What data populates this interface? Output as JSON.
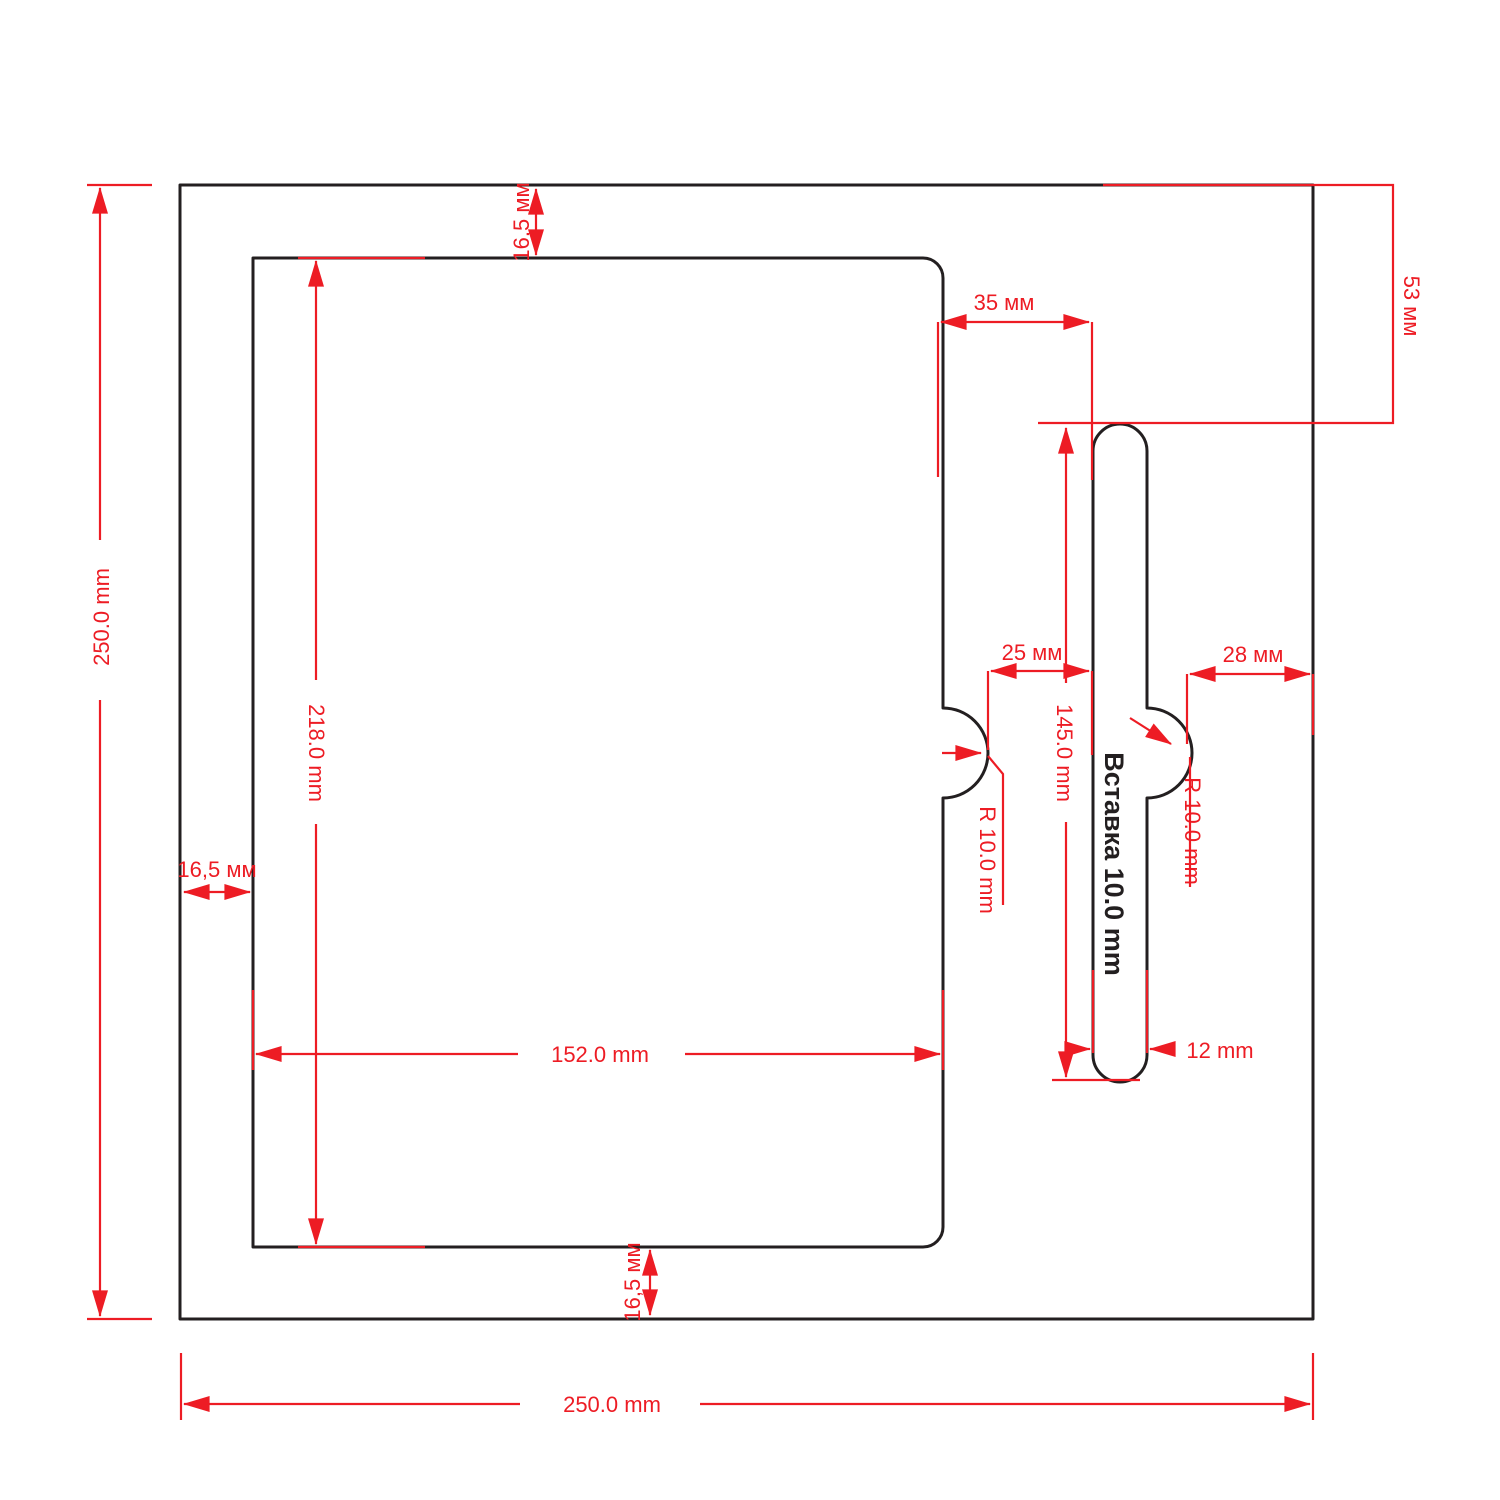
{
  "drawing": {
    "description": "cutting layout drawing of square panel with cutout and insert slot",
    "colors": {
      "dimension_red": "#ed1c24",
      "outline_black": "#231f20",
      "background": "#ffffff"
    },
    "labels": {
      "outer_height": "250.0 mm",
      "outer_width": "250.0 mm",
      "inset_top": "16,5 мм",
      "inset_left": "16,5 мм",
      "inset_bottom": "16,5 мм",
      "cutout_height": "218.0 mm",
      "cutout_width": "152.0 mm",
      "slot_top_offset": "53 мм",
      "cutout_to_slot_gap": "35 мм",
      "notch_to_slot_gap": "25 мм",
      "notch_to_edge_gap": "28 мм",
      "slot_height": "145.0 mm",
      "slot_width": "12 mm",
      "notch_radius_left": "R 10.0 mm",
      "notch_radius_right": "R 10.0 mm",
      "insert_caption": "Вставка 10.0 mm"
    }
  }
}
